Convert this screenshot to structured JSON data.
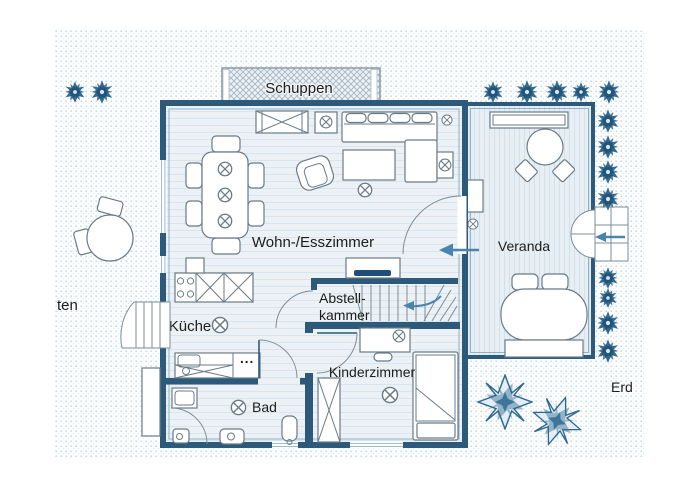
{
  "plan": {
    "labels": {
      "shed": "Schuppen",
      "living_dining": "Wohn-/Esszimmer",
      "veranda": "Veranda",
      "kitchen": "Küche",
      "storage_line1": "Abstell-",
      "storage_line2": "kammer",
      "kids_room": "Kinderzimmer",
      "bath": "Bad",
      "garden_partial": "ten",
      "floor_partial": "Erd",
      "kitchen_dots": "..."
    },
    "colors": {
      "wall": "#2d5a7a",
      "wall_accent": "#8fb2c9",
      "floor": "#ebf1f5",
      "floor_line": "#dae4ec",
      "veranda_floor": "#e8eff4",
      "garden_dot": "#c4d6e2",
      "furniture_outline": "#6a7b87",
      "plant": "#2f6a91",
      "arrow": "#4a84ae",
      "tv": "#1f4e79",
      "hatch": "#a9bcc9",
      "text": "#1d1d1b"
    }
  }
}
